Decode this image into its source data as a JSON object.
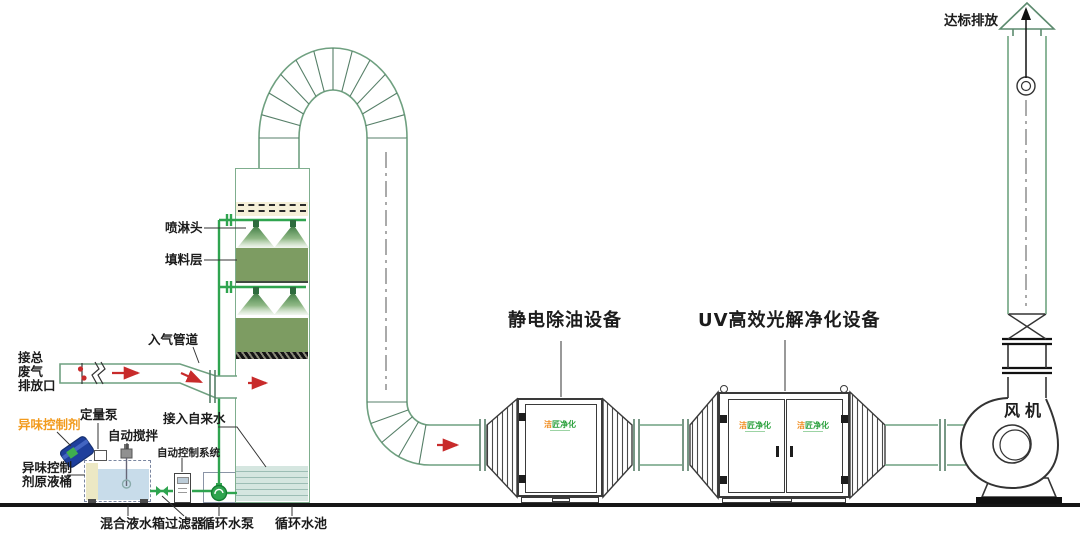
{
  "diagram": {
    "labels": {
      "waste_inlet": "接总\n废气\n排放口",
      "inlet_duct": "入气管道",
      "spray_head": "喷淋头",
      "packing_layer": "填料层",
      "odor_agent": "异味控制剂",
      "metering_pump": "定量泵",
      "auto_stir": "自动搅拌",
      "agent_barrel": "异味控制\n剂原液桶",
      "control_system": "自动控制系统",
      "tap_water": "接入自来水",
      "mixing_tank": "混合液水箱",
      "filter": "过滤器",
      "circ_pump": "循环水泵",
      "circ_pool": "循环水池",
      "esp_title": "静电除油设备",
      "uv_title": "UV高效光解净化设备",
      "fan": "风机",
      "emission": "达标排放"
    },
    "logo": {
      "first": "洁",
      "rest": "匠净化"
    },
    "colors": {
      "outline_green": "#7fae8e",
      "pipe_green": "#2fa44f",
      "packing_green": "#7d9c62",
      "demister_cream": "#f6f0d8",
      "pool_water": "#d5e6e0",
      "tank_water": "#c8dcea",
      "barrel_blue": "#1e3f9c",
      "arrow_red": "#c82b2b",
      "label_orange": "#f29b1e",
      "equipment_outline": "#3a3a3a"
    }
  }
}
